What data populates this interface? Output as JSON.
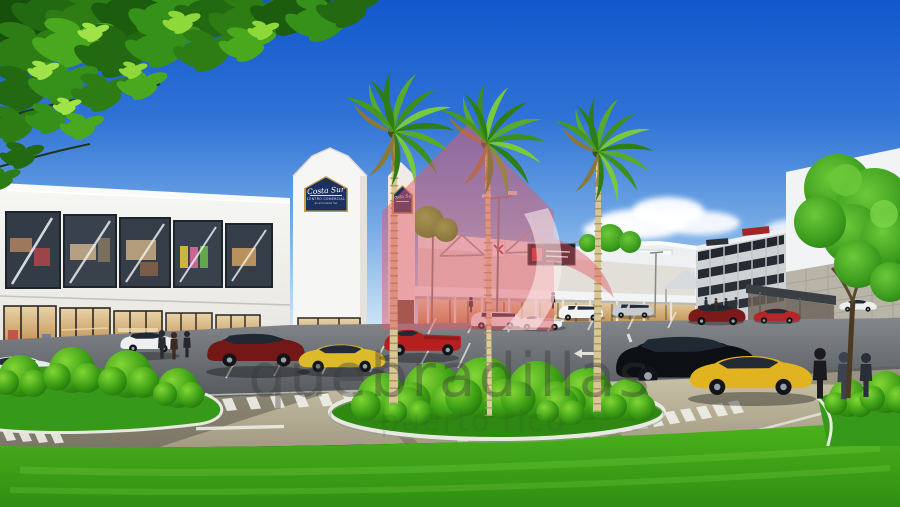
{
  "image": {
    "type": "architectural-rendering",
    "subject": "two-story shopping center with palm trees, landscaped traffic island and parking lot"
  },
  "signs": {
    "main": {
      "script": "Costa Sur",
      "line1": "CENTRO COMERCIAL",
      "tagline": "en el Corredor Sur"
    },
    "tower_small": {
      "script": "Costa Sur"
    }
  },
  "watermark": {
    "line1": "quebradillas",
    "line2": "puerto rico",
    "logo": "house-logo"
  },
  "colors": {
    "sky_top": "#1257cc",
    "sky_horizon": "#d6e8f8",
    "grass": "#3fa81e",
    "asphalt": "#5c5f63",
    "road_concrete": "#bfb79e",
    "sign_navy": "#1d3160",
    "sign_gold": "#c99b45",
    "watermark_pink": "#e25965",
    "watermark_gray": "#373737"
  }
}
